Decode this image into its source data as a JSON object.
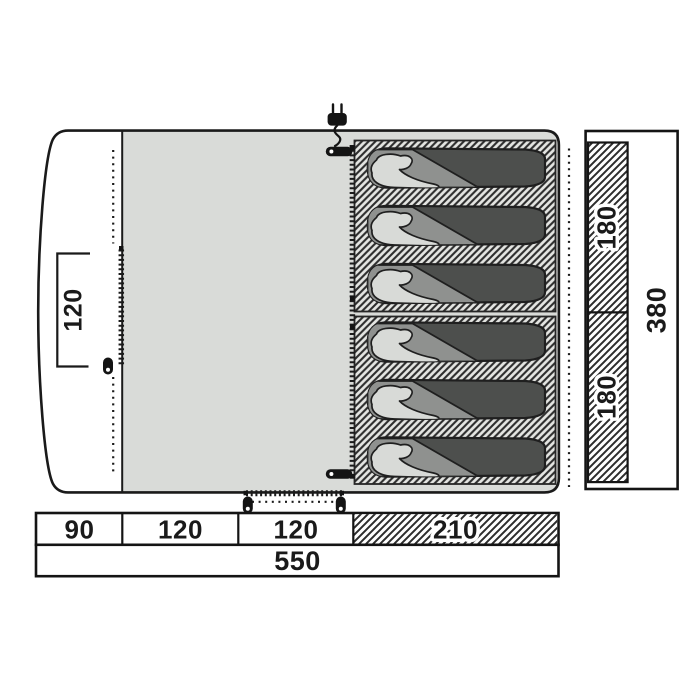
{
  "dims": {
    "porch_depth": "120",
    "length_segments": [
      "90",
      "120",
      "120",
      "210"
    ],
    "length_total": "550",
    "width_segments": [
      "180",
      "180"
    ],
    "width_total": "380"
  },
  "sleeping": {
    "bag_count": 6,
    "pod_count": 2
  },
  "icons": [
    "power-plug-icon",
    "zipper-pull-icon",
    "zipper-teeth-line",
    "mesh-dotted-line"
  ],
  "colors": {
    "outline": "#1a1a1a",
    "floor": "#d9dbd8",
    "pod_hatch_bg": "#e4e5e2",
    "bag_body": "#4d4f4d",
    "bag_flap": "#8f918f",
    "bag_pillow": "#d8dad7",
    "dim_text": "#1a1a1a"
  }
}
